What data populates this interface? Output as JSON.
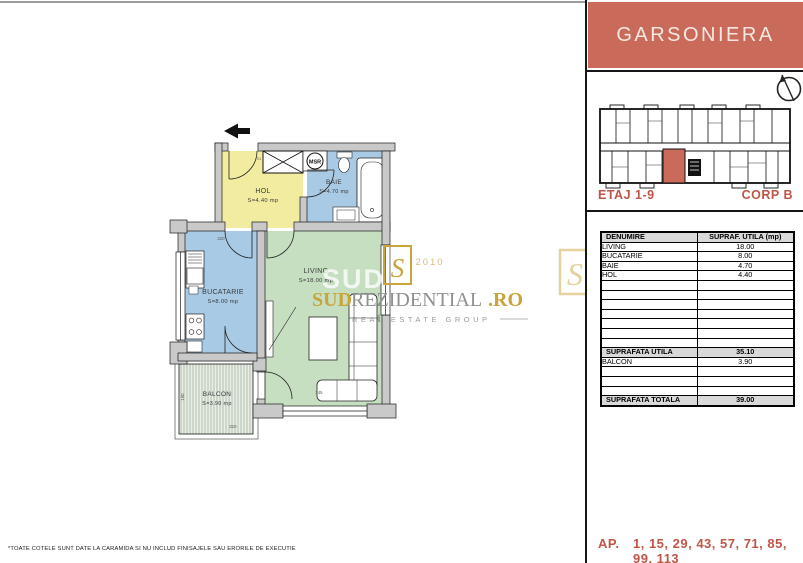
{
  "title": "GARSONIERA",
  "floor_label": "ETAJ 1-9",
  "corp_label": "CORP B",
  "ap": {
    "label": "AP.",
    "numbers": "1, 15, 29, 43, 57, 71, 85, 99, 113"
  },
  "footnote": "*TOATE COTELE SUNT DATE LA CARAMIDA SI NU INCLUD FINISAJELE SAU ERORILE DE EXECUTIE",
  "colors": {
    "accent_box": "#c96a5b",
    "accent_text": "#bf5546",
    "hol_yellow": "#f2eca0",
    "wet_blue": "#a8cae4",
    "living_green": "#c5dfc0",
    "wall_gray": "#c9c9c9",
    "table_header_bg": "#d9d9d9",
    "watermark_gold": "#c9a43b"
  },
  "plan": {
    "msr": "MSR",
    "rooms": [
      {
        "name": "HOL",
        "area": "S=4.40 mp"
      },
      {
        "name": "BAIE",
        "area": "S=4.70 mp"
      },
      {
        "name": "BUCATARIE",
        "area": "S=8.00 mp"
      },
      {
        "name": "LIVING",
        "area": "S=18.00 mp"
      },
      {
        "name": "BALCON",
        "area": "S=3.90 mp"
      }
    ],
    "dims": {
      "kitchen_width": "220",
      "shaft": "21",
      "living_width": "345",
      "living_height": "305",
      "balcony_height": "190",
      "balcony_width": "210"
    }
  },
  "watermark": {
    "ghost": "SUD RE",
    "emblem_letter": "S",
    "year": "2010",
    "brand_sud": "SUD",
    "brand_rest": "REZIDENTIAL",
    "brand_tld": ".RO",
    "tagline": "REAL ESTATE GROUP"
  },
  "table": {
    "headers": [
      "DENUMIRE",
      "SUPRAF. UTILA (mp)"
    ],
    "rows": [
      {
        "name": "LIVING",
        "value": "18.00"
      },
      {
        "name": "BUCATARIE",
        "value": "8.00"
      },
      {
        "name": "BAIE",
        "value": "4.70"
      },
      {
        "name": "HOL",
        "value": "4.40"
      }
    ],
    "subtotal": {
      "name": "SUPRAFATA UTILA",
      "value": "35.10"
    },
    "extra": {
      "name": "BALCON",
      "value": "3.90"
    },
    "total": {
      "name": "SUPRAFATA TOTALA",
      "value": "39.00"
    }
  }
}
